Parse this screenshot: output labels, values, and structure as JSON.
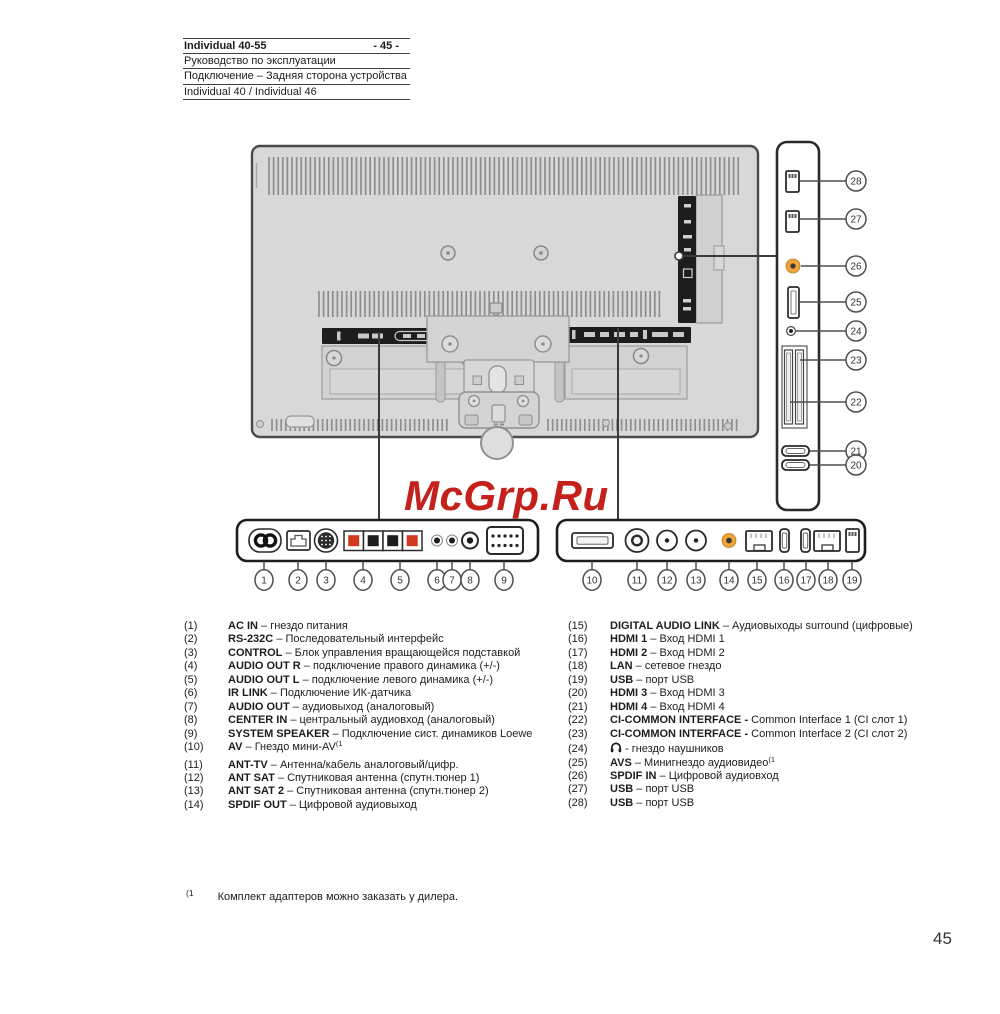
{
  "header": {
    "model": "Individual 40-55",
    "page_ref": "- 45 -",
    "row2": "Руководство по эксплуатации",
    "row3": "Подключение – Задняя сторона устройства",
    "row4": "Individual 40 / Individual 46"
  },
  "watermark": {
    "text": "McGrp.Ru",
    "color": "#c5211c"
  },
  "diagram": {
    "colors": {
      "orange": "#f0a43c",
      "terminal_red": "#d2381f",
      "terminal_black": "#1d1d1d",
      "panel_dark": "#1d1d1d"
    },
    "side_callouts": [
      {
        "n": 28,
        "cy": 181,
        "lx": 800
      },
      {
        "n": 27,
        "cy": 219,
        "lx": 800
      },
      {
        "n": 26,
        "cy": 266,
        "lx": 801
      },
      {
        "n": 25,
        "cy": 302,
        "lx": 800
      },
      {
        "n": 24,
        "cy": 331,
        "lx": 796
      },
      {
        "n": 23,
        "cy": 360,
        "lx": 800
      },
      {
        "n": 22,
        "cy": 402,
        "lx": 790
      },
      {
        "n": 21,
        "cy": 451,
        "lx": 810
      },
      {
        "n": 20,
        "cy": 465,
        "lx": 810
      }
    ],
    "bottom_left_callouts": [
      {
        "n": 1,
        "x": 264
      },
      {
        "n": 2,
        "x": 298
      },
      {
        "n": 3,
        "x": 326
      },
      {
        "n": 4,
        "x": 363
      },
      {
        "n": 5,
        "x": 400
      },
      {
        "n": 6,
        "x": 437
      },
      {
        "n": 7,
        "x": 452
      },
      {
        "n": 8,
        "x": 470
      },
      {
        "n": 9,
        "x": 504
      }
    ],
    "bottom_right_callouts": [
      {
        "n": 10,
        "x": 592
      },
      {
        "n": 11,
        "x": 637
      },
      {
        "n": 12,
        "x": 667
      },
      {
        "n": 13,
        "x": 696
      },
      {
        "n": 14,
        "x": 729
      },
      {
        "n": 15,
        "x": 757
      },
      {
        "n": 16,
        "x": 784
      },
      {
        "n": 17,
        "x": 806
      },
      {
        "n": 18,
        "x": 828
      },
      {
        "n": 19,
        "x": 852
      }
    ]
  },
  "legend": {
    "left": [
      {
        "n": 1,
        "bold": "AC IN",
        "text": "– гнездо питания"
      },
      {
        "n": 2,
        "bold": "RS-232C",
        "text": "– Последовательный интерфейс"
      },
      {
        "n": 3,
        "bold": "CONTROL",
        "text": "– Блок управления вращающейся подставкой"
      },
      {
        "n": 4,
        "bold": "AUDIO OUT R",
        "text": "– подключение правого динамика (+/-)"
      },
      {
        "n": 5,
        "bold": "AUDIO OUT L",
        "text": "– подключение левого динамика (+/-)"
      },
      {
        "n": 6,
        "bold": "IR LINK",
        "text": "– Подключение ИК-датчика"
      },
      {
        "n": 7,
        "bold": "AUDIO OUT",
        "text": "– аудиовыход (аналоговый)"
      },
      {
        "n": 8,
        "bold": "CENTER IN",
        "text": "– центральный аудиовход (аналоговый)"
      },
      {
        "n": 9,
        "bold": "SYSTEM SPEAKER",
        "text": "– Подключение сист. динамиков Loewe"
      },
      {
        "n": 10,
        "bold": "AV",
        "text": "– Гнездо мини-AV",
        "sup": "(1"
      },
      {
        "n": 11,
        "bold": "ANT-TV",
        "text": "– Антенна/кабель аналоговый/цифр.",
        "gap": true
      },
      {
        "n": 12,
        "bold": "ANT SAT",
        "text": "– Спутниковая антенна (спутн.тюнер 1)"
      },
      {
        "n": 13,
        "bold": "ANT SAT 2",
        "text": "– Спутниковая антенна (спутн.тюнер 2)"
      },
      {
        "n": 14,
        "bold": "SPDIF OUT",
        "text": "– Цифровой аудиовыход"
      }
    ],
    "right": [
      {
        "n": 15,
        "bold": "DIGITAL AUDIO LINK",
        "text": "– Аудиовыходы surround (цифровые)"
      },
      {
        "n": 16,
        "bold": "HDMI 1",
        "text": "– Вход HDMI 1"
      },
      {
        "n": 17,
        "bold": "HDMI 2",
        "text": "– Вход HDMI 2"
      },
      {
        "n": 18,
        "bold": "LAN",
        "text": "– сетевое гнездо"
      },
      {
        "n": 19,
        "bold": "USB",
        "text": "– порт USB"
      },
      {
        "n": 20,
        "bold": "HDMI 3",
        "text": "– Вход HDMI 3"
      },
      {
        "n": 21,
        "bold": "HDMI 4",
        "text": "– Вход HDMI 4"
      },
      {
        "n": 22,
        "bold": "CI-COMMON INTERFACE -",
        "text": "Common Interface 1 (CI слот 1)"
      },
      {
        "n": 23,
        "bold": "CI-COMMON INTERFACE -",
        "text": "Common Interface 2 (CI слот 2)"
      },
      {
        "n": 24,
        "icon": "headphones-icon",
        "text": "- гнездо наушников"
      },
      {
        "n": 25,
        "bold": "AVS",
        "text": "– Минигнездо аудиовидео",
        "sup": "(1"
      },
      {
        "n": 26,
        "bold": "SPDIF IN",
        "text": "– Цифровой аудиовход"
      },
      {
        "n": 27,
        "bold": "USB",
        "text": "– порт USB"
      },
      {
        "n": 28,
        "bold": "USB",
        "text": "– порт USB"
      }
    ]
  },
  "footnote": {
    "marker": "(1",
    "text": "Комплект адаптеров можно заказать у дилера."
  },
  "page_number": "45"
}
